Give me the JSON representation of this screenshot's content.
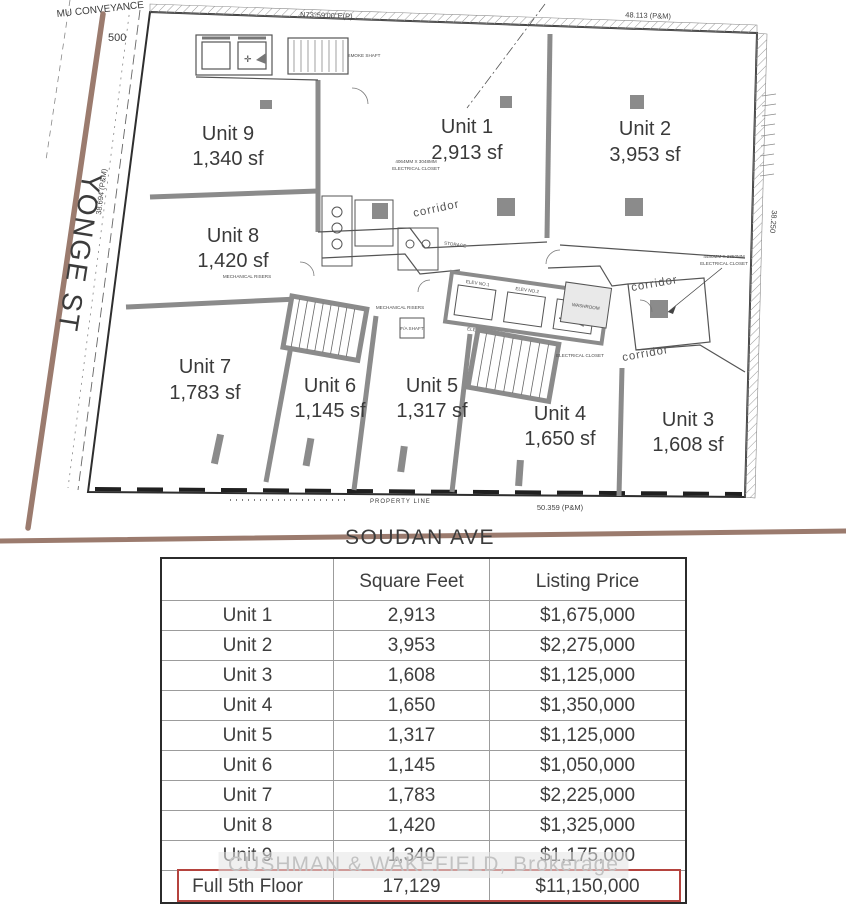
{
  "floor_plan": {
    "street_left": "YONGE ST",
    "street_bottom": "SOUDAN AVE",
    "conveyance_label": "MU CONVEYANCE",
    "conveyance_number": "500",
    "bearing_top": "N73°59'00\"E(P)",
    "dim_top": "48.113 (P&M)",
    "dim_left": "38.694 (P&M)",
    "dim_right": "38.250",
    "dim_bottom": "50.359 (P&M)",
    "property_line_label": "PROPERTY LINE",
    "corridor_label": "corridor",
    "core": {
      "smoke_shaft": "SMOKE SHAFT",
      "elevator_lobby": "ELEVATOR LOBBY",
      "elev_1": "ELEV NO.1",
      "elev_2": "ELEV NO.2",
      "elev_3": "ELEV NO.3",
      "storage": "STORAGE",
      "mechanical_risers": "MECHANICAL RISERS",
      "fa_shaft": "F/A SHAFT",
      "washroom": "WASHROOM",
      "electrical_closet": "ELECTRICAL CLOSET",
      "electrical_closet_dim_1": "4064MM X 3048MM",
      "electrical_closet_dim_2": "4480MM X 2850MM"
    },
    "units": [
      {
        "name": "Unit 1",
        "area": "2,913 sf"
      },
      {
        "name": "Unit 2",
        "area": "3,953 sf"
      },
      {
        "name": "Unit 3",
        "area": "1,608 sf"
      },
      {
        "name": "Unit 4",
        "area": "1,650 sf"
      },
      {
        "name": "Unit 5",
        "area": "1,317 sf"
      },
      {
        "name": "Unit 6",
        "area": "1,145 sf"
      },
      {
        "name": "Unit 7",
        "area": "1,783 sf"
      },
      {
        "name": "Unit 8",
        "area": "1,420 sf"
      },
      {
        "name": "Unit 9",
        "area": "1,340 sf"
      }
    ]
  },
  "table": {
    "headers": {
      "unit": "",
      "sqft": "Square Feet",
      "price": "Listing Price"
    },
    "rows": [
      {
        "unit": "Unit 1",
        "sqft": "2,913",
        "price": "$1,675,000"
      },
      {
        "unit": "Unit 2",
        "sqft": "3,953",
        "price": "$2,275,000"
      },
      {
        "unit": "Unit 3",
        "sqft": "1,608",
        "price": "$1,125,000"
      },
      {
        "unit": "Unit 4",
        "sqft": "1,650",
        "price": "$1,350,000"
      },
      {
        "unit": "Unit 5",
        "sqft": "1,317",
        "price": "$1,125,000"
      },
      {
        "unit": "Unit 6",
        "sqft": "1,145",
        "price": "$1,050,000"
      },
      {
        "unit": "Unit 7",
        "sqft": "1,783",
        "price": "$2,225,000"
      },
      {
        "unit": "Unit 8",
        "sqft": "1,420",
        "price": "$1,325,000"
      },
      {
        "unit": "Unit 9",
        "sqft": "1,340",
        "price": "$1,175,000"
      },
      {
        "unit": "Full 5th Floor",
        "sqft": "17,129",
        "price": "$11,150,000",
        "highlighted": true
      }
    ],
    "highlight_color": "#b5433e"
  },
  "watermark": "CUSHMAN & WAKEFIELD, Brokerage",
  "colors": {
    "street": "#9b7b6e",
    "plan_line": "#3f3f3f",
    "demising_wall": "#8b8b8b",
    "red_highlight": "#b5433e"
  }
}
